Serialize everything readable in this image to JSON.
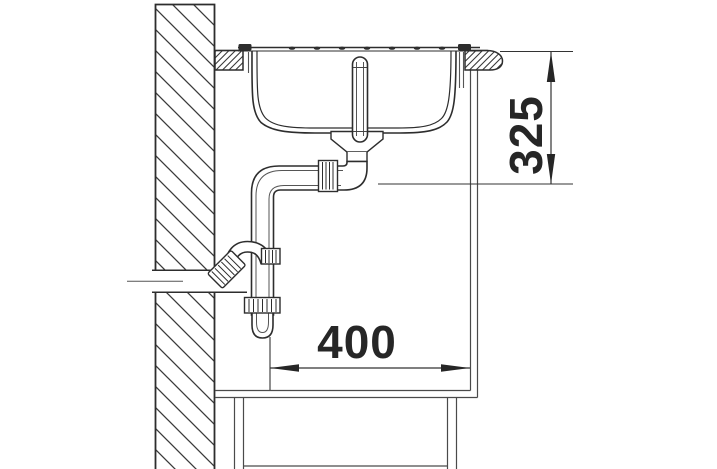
{
  "drawing": {
    "type": "technical-section-drawing",
    "subject": "kitchen-sink-installation-side-view",
    "line_color": "#2d2d2d",
    "background_color": "#ffffff",
    "components": [
      "wall",
      "countertop",
      "sink-rim",
      "sink-bowl",
      "overflow-standpipe",
      "drain-fitting",
      "drain-elbow",
      "pipe-coupling",
      "siphon-trap",
      "wall-outlet-pipe",
      "base-cabinet",
      "plinth"
    ]
  },
  "dimensions": {
    "vertical": {
      "value": "325",
      "orientation": "vertical"
    },
    "horizontal": {
      "value": "400",
      "orientation": "horizontal"
    }
  }
}
